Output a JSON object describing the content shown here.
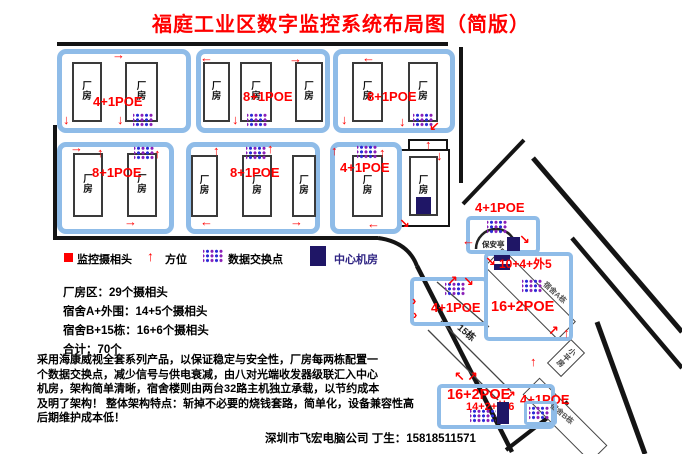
{
  "title": "福庭工业区数字监控系统布局图（简版）",
  "labels": {
    "factory_building": "厂房"
  },
  "icons": {
    "up": "↑",
    "down": "↓",
    "left": "←",
    "right": "→",
    "up_right": "↗",
    "down_right": "↘",
    "down_left": "↙",
    "up_left": "↖",
    "chevron": "›"
  },
  "blocks": [
    {
      "label": "4+1POE"
    },
    {
      "label": "8+1POE"
    },
    {
      "label": "8+1POE"
    },
    {
      "label": "8+1POE"
    },
    {
      "label": "8+1POE"
    },
    {
      "label": "4+1POE"
    }
  ],
  "legend": {
    "camera": "监控摄相头",
    "direction": "方位",
    "switch": "数据交换点",
    "server_room": "中心机房"
  },
  "stats": [
    "厂房区：29个摄相头",
    "宿舍A+外围：14+5个摄相头",
    "宿舍B+15栋：16+6个摄相头",
    "合计：70个"
  ],
  "description": [
    "采用海康威视全套系列产品，以保证稳定与安全性，厂房每两栋配置一",
    "个数据交换点，减少信号与供电衰减，由八对光端收发器级联汇入中心",
    "机房，架构简单清晰，宿舍楼则由两台32路主机独立承载，以节约成本",
    "及明了架构！ 整体架构特点：斩掉不必要的烧钱套路，简单化，设备兼容性高",
    "后期维护成本低！"
  ],
  "footer": "深圳市飞宏电脑公司 丁生：15818511571",
  "map": {
    "security": {
      "poe": "4+1POE",
      "booth": "保安亭"
    },
    "dorm_a": {
      "top": "10+4+外5",
      "poe": "16+2POE",
      "name": "宿舍A栋"
    },
    "mid": {
      "poe": "4+1POE"
    },
    "row15": "15栋",
    "small_house": "小平房",
    "dorm_b": {
      "poe": "16+2POE",
      "inner": "14+2+外6",
      "right_poe": "4+1POE",
      "name": "宿舍B栋"
    }
  },
  "colors": {
    "accent_red": "#FF0000",
    "highlight_blue": "#8FBCE8",
    "switch_blue": "#2B2BD6",
    "switch_purple": "#8A1FB8",
    "server_navy": "#1F1666"
  }
}
